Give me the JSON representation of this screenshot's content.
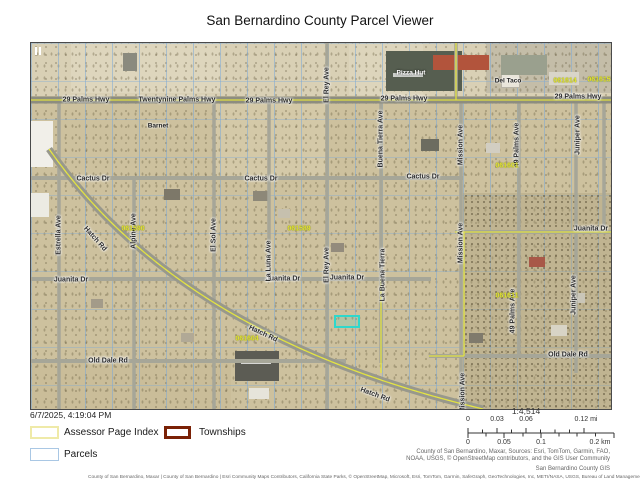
{
  "title": "San Bernardino County Parcel Viewer",
  "timestamp": "6/7/2025, 4:19:04 PM",
  "legend": {
    "items": [
      {
        "label": "Assessor Page Index",
        "color": "#efeaa8"
      },
      {
        "label": "Townships",
        "color": "#7a2106"
      },
      {
        "label": "Parcels",
        "color": "#a9c7e4"
      }
    ]
  },
  "scale": {
    "ratio": "1:4,514",
    "mi_ticks": [
      "0",
      "0.03",
      "0.06",
      "0.12 mi"
    ],
    "km_ticks": [
      "0",
      "0.05",
      "0.1",
      "0.2 km"
    ]
  },
  "attribution": {
    "right_line1": "County of San Bernardino, Maxar, Sources: Esri, TomTom, Garmin, FAO,",
    "right_line2": "NOAA, USGS, © OpenStreetMap contributors, and the GIS User Community",
    "credit": "San Bernardino County GIS",
    "bottom": "County of San Bernardino, Maxar | County of San Bernardino | Esri Community Maps Contributors, California State Parks, © OpenStreetMap, Microsoft, Esri, TomTom, Garmin, SafeGraph, GeoTechnologies, Inc, METI/NASA, USGS, Bureau of Land Management, EPA,"
  },
  "map": {
    "selected_parcel_color": "#2ed8cc",
    "labels": [
      {
        "t": "29 Palms Hwy",
        "x": 55,
        "y": 57,
        "cls": "road"
      },
      {
        "t": "Twentynine Palms Hwy",
        "x": 146,
        "y": 57,
        "cls": "road"
      },
      {
        "t": "29 Palms Hwy",
        "x": 238,
        "y": 58,
        "cls": "road"
      },
      {
        "t": "29 Palms Hwy",
        "x": 373,
        "y": 56,
        "cls": "road"
      },
      {
        "t": "29 Palms Hwy",
        "x": 547,
        "y": 54,
        "cls": "road"
      },
      {
        "t": "Cactus Dr",
        "x": 62,
        "y": 136,
        "cls": "road"
      },
      {
        "t": "Cactus Dr",
        "x": 230,
        "y": 136,
        "cls": "road"
      },
      {
        "t": "Cactus Dr",
        "x": 392,
        "y": 134,
        "cls": "road"
      },
      {
        "t": "Juanita Dr",
        "x": 40,
        "y": 237,
        "cls": "road"
      },
      {
        "t": "Juanita Dr",
        "x": 252,
        "y": 236,
        "cls": "road"
      },
      {
        "t": "Juanita Dr",
        "x": 316,
        "y": 235,
        "cls": "road"
      },
      {
        "t": "Juanita Dr",
        "x": 560,
        "y": 186,
        "cls": "road"
      },
      {
        "t": "Old Dale Rd",
        "x": 77,
        "y": 318,
        "cls": "road"
      },
      {
        "t": "Old Dale Rd",
        "x": 537,
        "y": 312,
        "cls": "road"
      },
      {
        "t": "Hatch Rd",
        "x": 64,
        "y": 196,
        "cls": "road",
        "rot": 48
      },
      {
        "t": "Hatch Rd",
        "x": 232,
        "y": 291,
        "cls": "road",
        "rot": 25
      },
      {
        "t": "Hatch Rd",
        "x": 344,
        "y": 352,
        "cls": "road",
        "rot": 20
      },
      {
        "t": "Estrella Ave",
        "x": 28,
        "y": 192,
        "cls": "vst"
      },
      {
        "t": "Alpine Ave",
        "x": 103,
        "y": 188,
        "cls": "vst"
      },
      {
        "t": "El Sol Ave",
        "x": 183,
        "y": 192,
        "cls": "vst"
      },
      {
        "t": "La Luna Ave",
        "x": 238,
        "y": 218,
        "cls": "vst"
      },
      {
        "t": "El Rey Ave",
        "x": 296,
        "y": 42,
        "cls": "vst"
      },
      {
        "t": "El Rey Ave",
        "x": 296,
        "y": 222,
        "cls": "vst"
      },
      {
        "t": "Buena Tierra Ave",
        "x": 350,
        "y": 96,
        "cls": "vst"
      },
      {
        "t": "La Buena Tierra",
        "x": 352,
        "y": 232,
        "cls": "vst"
      },
      {
        "t": "Mission Ave",
        "x": 430,
        "y": 102,
        "cls": "vst"
      },
      {
        "t": "Mission Ave",
        "x": 430,
        "y": 200,
        "cls": "vst"
      },
      {
        "t": "Mission Ave",
        "x": 432,
        "y": 350,
        "cls": "vst"
      },
      {
        "t": "49 Palms Ave",
        "x": 486,
        "y": 102,
        "cls": "vst"
      },
      {
        "t": "49 Palms Ave",
        "x": 482,
        "y": 268,
        "cls": "vst"
      },
      {
        "t": "Juniper Ave",
        "x": 547,
        "y": 92,
        "cls": "vst"
      },
      {
        "t": "Juniper Ave",
        "x": 543,
        "y": 252,
        "cls": "vst"
      },
      {
        "t": "Pizza Hut",
        "x": 380,
        "y": 30,
        "cls": "poiw"
      },
      {
        "t": "Del Taco",
        "x": 477,
        "y": 38,
        "cls": "poi"
      },
      {
        "t": "Barnet",
        "x": 127,
        "y": 83,
        "cls": "poi"
      },
      {
        "t": "061590",
        "x": 102,
        "y": 186,
        "cls": "page"
      },
      {
        "t": "061589",
        "x": 268,
        "y": 186,
        "cls": "page"
      },
      {
        "t": "061601",
        "x": 476,
        "y": 123,
        "cls": "page"
      },
      {
        "t": "061614",
        "x": 534,
        "y": 38,
        "cls": "page"
      },
      {
        "t": "061615",
        "x": 568,
        "y": 37,
        "cls": "page"
      },
      {
        "t": "061604",
        "x": 216,
        "y": 296,
        "cls": "page"
      },
      {
        "t": "061611",
        "x": 476,
        "y": 253,
        "cls": "page"
      }
    ]
  }
}
